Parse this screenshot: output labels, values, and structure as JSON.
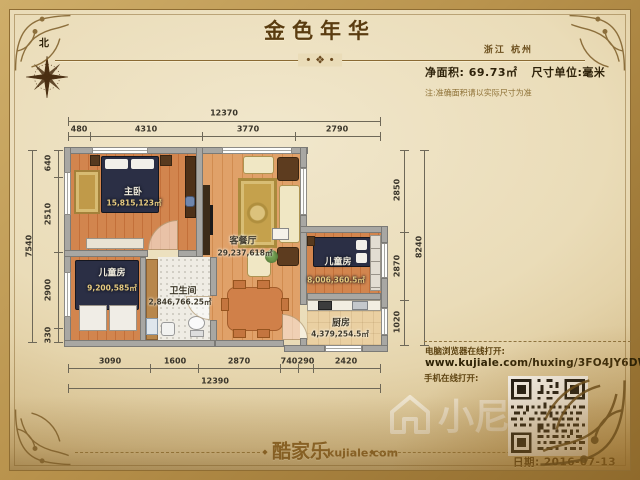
{
  "header": {
    "title": "金色年华",
    "ornament": "• ❖ •",
    "location": "浙江 杭州",
    "net_area": "净面积:  69.73㎡",
    "unit": "尺寸单位:毫米",
    "note": "注:准确面积请以实际尺寸为准"
  },
  "compass": {
    "north": "北"
  },
  "rooms": [
    {
      "name": "主卧",
      "area": "15,815,123㎡"
    },
    {
      "name": "客餐厅",
      "area": "29,237,618㎡"
    },
    {
      "name": "儿童房",
      "area": "9,200,585㎡"
    },
    {
      "name": "卫生间",
      "area": "2,846,766.25㎡"
    },
    {
      "name": "儿童房",
      "area": "8,006,360.5㎡"
    },
    {
      "name": "厨房",
      "area": "4,379,254.5㎡"
    }
  ],
  "dimensions": {
    "top_total": "12370",
    "top_segments": [
      "480",
      "4310",
      "3770",
      "2790"
    ],
    "left_total": "7540",
    "left_segments": [
      "640",
      "2510",
      "2900",
      "330"
    ],
    "right_total": "8240",
    "right_segments": [
      "2850",
      "2870",
      "1020"
    ],
    "bottom_total": "12390",
    "bottom_segments": [
      "3090",
      "1600",
      "2870",
      "740",
      "290",
      "2420"
    ]
  },
  "share": {
    "pc_label": "电脑浏览器在线打开:",
    "url": "www.kujiale.com/huxing/3FO4JY6DW259",
    "mobile_label": "手机在线打开:",
    "date": "日期: 2016-07-13"
  },
  "footer": {
    "brand": "酷家乐",
    "domain": "kujiale.com",
    "diamond": "◆"
  },
  "watermark": {
    "text": "小尼"
  },
  "colors": {
    "parchment": "#eadcb8",
    "frame_gold": "#b8924c",
    "title_brown": "#5a3c10",
    "wall_gray": "#a8a7a3",
    "floor_wood": "#d2854e",
    "floor_living": "#e0a169",
    "bed_navy": "#2b2f45",
    "rug_gold": "#c5a14c"
  }
}
